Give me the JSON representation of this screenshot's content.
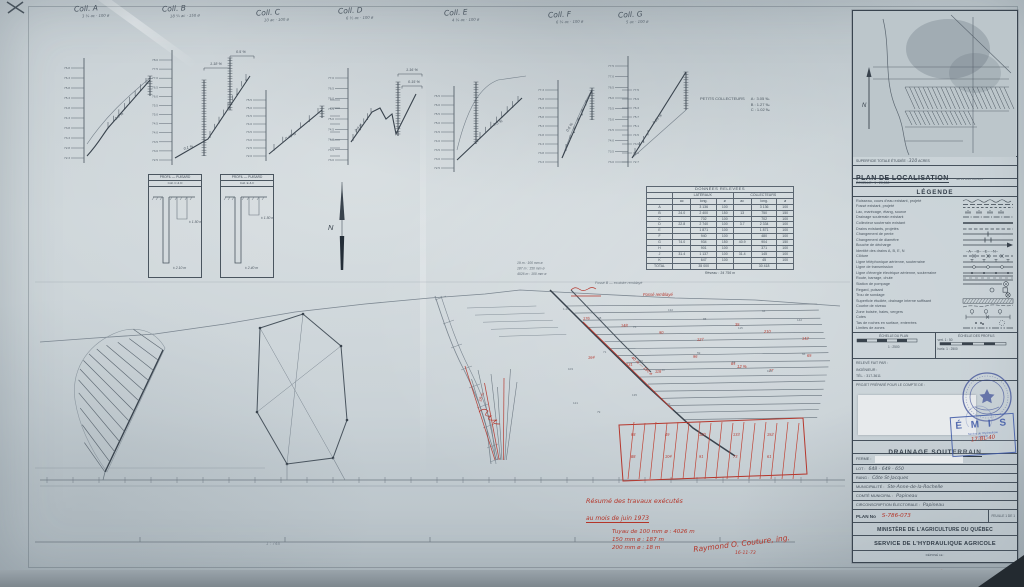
{
  "profiles": {
    "charts": [
      {
        "label": "Coll. A",
        "sub": "3 ¾ ac · 100 ø",
        "ticks": [
          "76.8",
          "76.3",
          "75.8",
          "75.3",
          "74.8",
          "74.3",
          "73.8",
          "73.3",
          "72.8",
          "72.3"
        ],
        "grades": [
          "1.0 %"
        ]
      },
      {
        "label": "Coll. B",
        "sub": "18 ¼ ac · 150 ø",
        "ticks": [
          "78.0",
          "77.5",
          "77.0",
          "76.5",
          "76.0",
          "75.5",
          "75.0",
          "74.5",
          "74.0",
          "73.5",
          "73.0",
          "72.5"
        ],
        "grades": [
          "0.1 %",
          "1.18 %",
          "0.5 %"
        ]
      },
      {
        "label": "Coll. C",
        "sub": "10 ac · 100 ø",
        "ticks": [
          "75.5",
          "75.0",
          "74.5",
          "74.0",
          "73.5",
          "73.0",
          "72.5",
          "72.0"
        ],
        "ticks2": [
          "74.8",
          "74.3",
          "73.8",
          "73.3",
          "72.8",
          "72.3",
          "71.8",
          "71.3"
        ],
        "grades": [
          "0.45 %"
        ]
      },
      {
        "label": "Coll. D",
        "sub": "6 ½ ac · 100 ø",
        "ticks": [
          "77.0",
          "76.5",
          "76.0",
          "75.5",
          "75.0",
          "74.5",
          "74.0",
          "73.5",
          "73.0"
        ],
        "grades": [
          "0.8 %",
          "1.16 %",
          "0.15 %"
        ]
      },
      {
        "label": "Coll. E",
        "sub": "4 ¼ ac · 100 ø",
        "ticks": [
          "76.5",
          "76.0",
          "75.5",
          "75.0",
          "74.5",
          "74.0",
          "73.5",
          "73.0",
          "72.5"
        ],
        "grades": [
          "0.5 %"
        ]
      },
      {
        "label": "Coll. F",
        "sub": "6 ¾ ac · 100 ø",
        "ticks": [
          "77.3",
          "76.8",
          "76.3",
          "75.8",
          "75.3",
          "74.8",
          "74.3",
          "73.8",
          "73.3"
        ],
        "ticks2": [
          "77.5",
          "76.9",
          "76.3",
          "75.7",
          "75.1",
          "74.5",
          "73.9",
          "73.3",
          "72.7"
        ],
        "grades": [
          "0.6 %"
        ]
      },
      {
        "label": "Coll. G",
        "sub": "5 ac · 100 ø",
        "ticks": [
          "77.5",
          "77.0",
          "76.5",
          "76.0",
          "75.5",
          "75.0",
          "74.5",
          "74.0",
          "73.5",
          "73.0"
        ],
        "grades": [
          "0.25 %"
        ]
      }
    ],
    "note_label": "PETITS COLLECTEURS",
    "note_items": [
      "A :  3.05 ‰",
      "B :  1.27 ‰",
      "C :  1.02 ‰"
    ]
  },
  "detail_boxes": [
    {
      "title": "PROFIL — PUISARD",
      "sub": "Coll. C & D",
      "dim1": "± 1.50 m",
      "dim2": "± 2.10 m"
    },
    {
      "title": "PROFIL — PUISARD",
      "sub": "Coll. E & F",
      "dim1": "± 1.50 m",
      "dim2": "± 2.40 m"
    }
  ],
  "table": {
    "title": "DONNÉES RELEVÉES",
    "groups": [
      "LATÉRAUX",
      "COLLECTEURS"
    ],
    "subheads": [
      "",
      "ac",
      "long.",
      "ø",
      "ac",
      "long.",
      "ø"
    ],
    "rows": [
      [
        "A",
        "",
        "3 136",
        "100",
        "",
        "3 136",
        "100"
      ],
      [
        "B",
        "24.0",
        "2 400",
        "150",
        "13",
        "750",
        "150"
      ],
      [
        "C",
        "",
        "702",
        "100",
        "",
        "702",
        "100"
      ],
      [
        "D",
        "22.8",
        "2 740",
        "100",
        "3.7",
        "2 334",
        "100"
      ],
      [
        "E",
        "",
        "1 871",
        "100",
        "",
        "1 871",
        "100"
      ],
      [
        "F",
        "",
        "940",
        "100",
        "",
        "480",
        "100"
      ],
      [
        "G",
        "74.0",
        "934",
        "150",
        "40.9",
        "904",
        "150"
      ],
      [
        "H",
        "",
        "901",
        "100",
        "",
        "371",
        "100"
      ],
      [
        "J",
        "31.4",
        "1 137",
        "100",
        "31.4",
        "145",
        "100"
      ],
      [
        "K",
        "",
        "647",
        "100",
        "",
        "45",
        "100"
      ],
      [
        "TOTAL",
        "",
        "35 000",
        "",
        "",
        "30 418",
        ""
      ]
    ],
    "footer": "Réseau : 34 756 m"
  },
  "north_label": "N",
  "plan": {
    "pencil_notes": [
      "19 m : 100 mm ø",
      "187 m : 150 mm ø",
      "4026 m : 100 mm ø"
    ],
    "pencil_note2": "Fossé B — exutoire remblayé",
    "red_labels": [
      "40 m — 150 ø",
      "12 %",
      "18 m",
      "Fossé remblayé"
    ],
    "red_figures": [
      "176",
      "148",
      "90",
      "127",
      "35",
      "210",
      "142",
      "164",
      "131",
      "118",
      "96",
      "84",
      "77",
      "65",
      "58",
      "49",
      "120",
      "133",
      "152",
      "88",
      "104",
      "91",
      "73",
      "61"
    ],
    "pencil_figures": [
      "1.26",
      "98",
      "76",
      "132",
      "88",
      "115",
      "64",
      "142",
      "103",
      "71",
      "126",
      "87",
      "59",
      "94",
      "108",
      "66",
      "121",
      "79",
      "135",
      "92"
    ],
    "scale_note": "1 : 744"
  },
  "red_notes": {
    "line1": "Résumé des travaux exécutés",
    "line2": "au mois de juin 1973",
    "items": [
      "Tuyau de 100 mm ø : 4026 m",
      "150 mm ø :  187 m",
      "200 mm ø :   18 m"
    ],
    "signature": "Raymond O. Couture, ing.",
    "date": "16-11-73"
  },
  "sidebar": {
    "superficie_label": "SUPERFICIE TOTALE ÉTUDIÉE :",
    "superficie_value": "310",
    "superficie_unit": "ACRES",
    "loc_title": "PLAN DE LOCALISATION",
    "loc_ref": "No 31 B/16 100-201",
    "loc_scale": "ÉCHELLE : 1 : 20,000",
    "legend_title": "LÉGENDE",
    "legend": [
      {
        "label": "Ruisseau, cours d'eau existant, projeté",
        "sym": "wavy"
      },
      {
        "label": "Fossé existant, projeté",
        "sym": "dash2"
      },
      {
        "label": "Lac, marécage, étang, source",
        "sym": "marsh"
      },
      {
        "label": "Drainage souterrain existant",
        "sym": "dashdot"
      },
      {
        "label": "Collecteur souterrain existant",
        "sym": "thick"
      },
      {
        "label": "Drains existants, projetés",
        "sym": "dashed"
      },
      {
        "label": "Changement de pente",
        "sym": "tick1"
      },
      {
        "label": "Changement de diamètre",
        "sym": "tick2"
      },
      {
        "label": "Bouche de décharge",
        "sym": "arrow"
      },
      {
        "label": "Identité des drains A, B, E, N",
        "sym": "letters"
      },
      {
        "label": "Clôture",
        "sym": "xline"
      },
      {
        "label": "Ligne téléphonique aérienne, souterraine",
        "sym": "tline"
      },
      {
        "label": "Ligne de transmission",
        "sym": "circ"
      },
      {
        "label": "Ligne d'énergie électrique aérienne, souterraine",
        "sym": "eline"
      },
      {
        "label": "Route, barrage, chute",
        "sym": "road"
      },
      {
        "label": "Station de pompage",
        "sym": "pump"
      },
      {
        "label": "Regard, puisard",
        "sym": "manhole"
      },
      {
        "label": "Trou de sondage",
        "sym": "bore"
      },
      {
        "label": "Superficie étudiée, drainage interne suffisant",
        "sym": "band"
      },
      {
        "label": "Courbe de niveau",
        "sym": "contour"
      },
      {
        "label": "Zone boisée, haies, vergers",
        "sym": "trees"
      },
      {
        "label": "Cotes",
        "sym": "dim"
      },
      {
        "label": "Tas de roches en surface, enterrées",
        "sym": "rocks"
      },
      {
        "label": "Limites de zones",
        "sym": "zone"
      }
    ],
    "scales": {
      "plan_label": "ÉCHELLE DU PLAN",
      "plan_value": "1 : 2500",
      "profils_label": "ÉCHELLE DES PROFILS",
      "vert": "vert.  1 : 50",
      "horiz": "horiz.  1 : 2500"
    },
    "info_lines": [
      "RELEVÉ FAIT PAR :",
      "INGÉNIEUR :",
      "TÉL. : 317-3611"
    ],
    "prepared_label": "PROJET PRÉPARÉ POUR LE COMPTE DE :",
    "emis": "É M I S",
    "emis_sub1": "Service de l'Hydraulique",
    "emis_sub2": "agricole",
    "title_block": {
      "drainage": "DRAINAGE SOUTERRAIN",
      "drainage_no_red": "17-BL-40",
      "ferme": "FERME :",
      "lot_label": "LOT :",
      "lot_value": "648 - 649 - 650",
      "rang_label": "RANG :",
      "rang_value": "Côte St-Jacques",
      "mun_label": "MUNICIPALITÉ :",
      "mun_value": "Ste-Anne-de-la-Rochelle",
      "comte_label": "COMTÉ MUNICIPAL :",
      "comte_value": "Papineau",
      "circ_label": "CIRCONSCRIPTION ÉLECTORALE :",
      "circ_value": "Papineau",
      "plan_no_label": "PLAN No",
      "plan_no_value": "S-786-073",
      "feuille": "FEUILLE 1 DE 1",
      "ministere": "MINISTÈRE DE L'AGRICULTURE DU QUÉBEC",
      "service": "SERVICE DE L'HYDRAULIQUE AGRICOLE",
      "depose": "DÉPOSÉ LE :"
    }
  }
}
